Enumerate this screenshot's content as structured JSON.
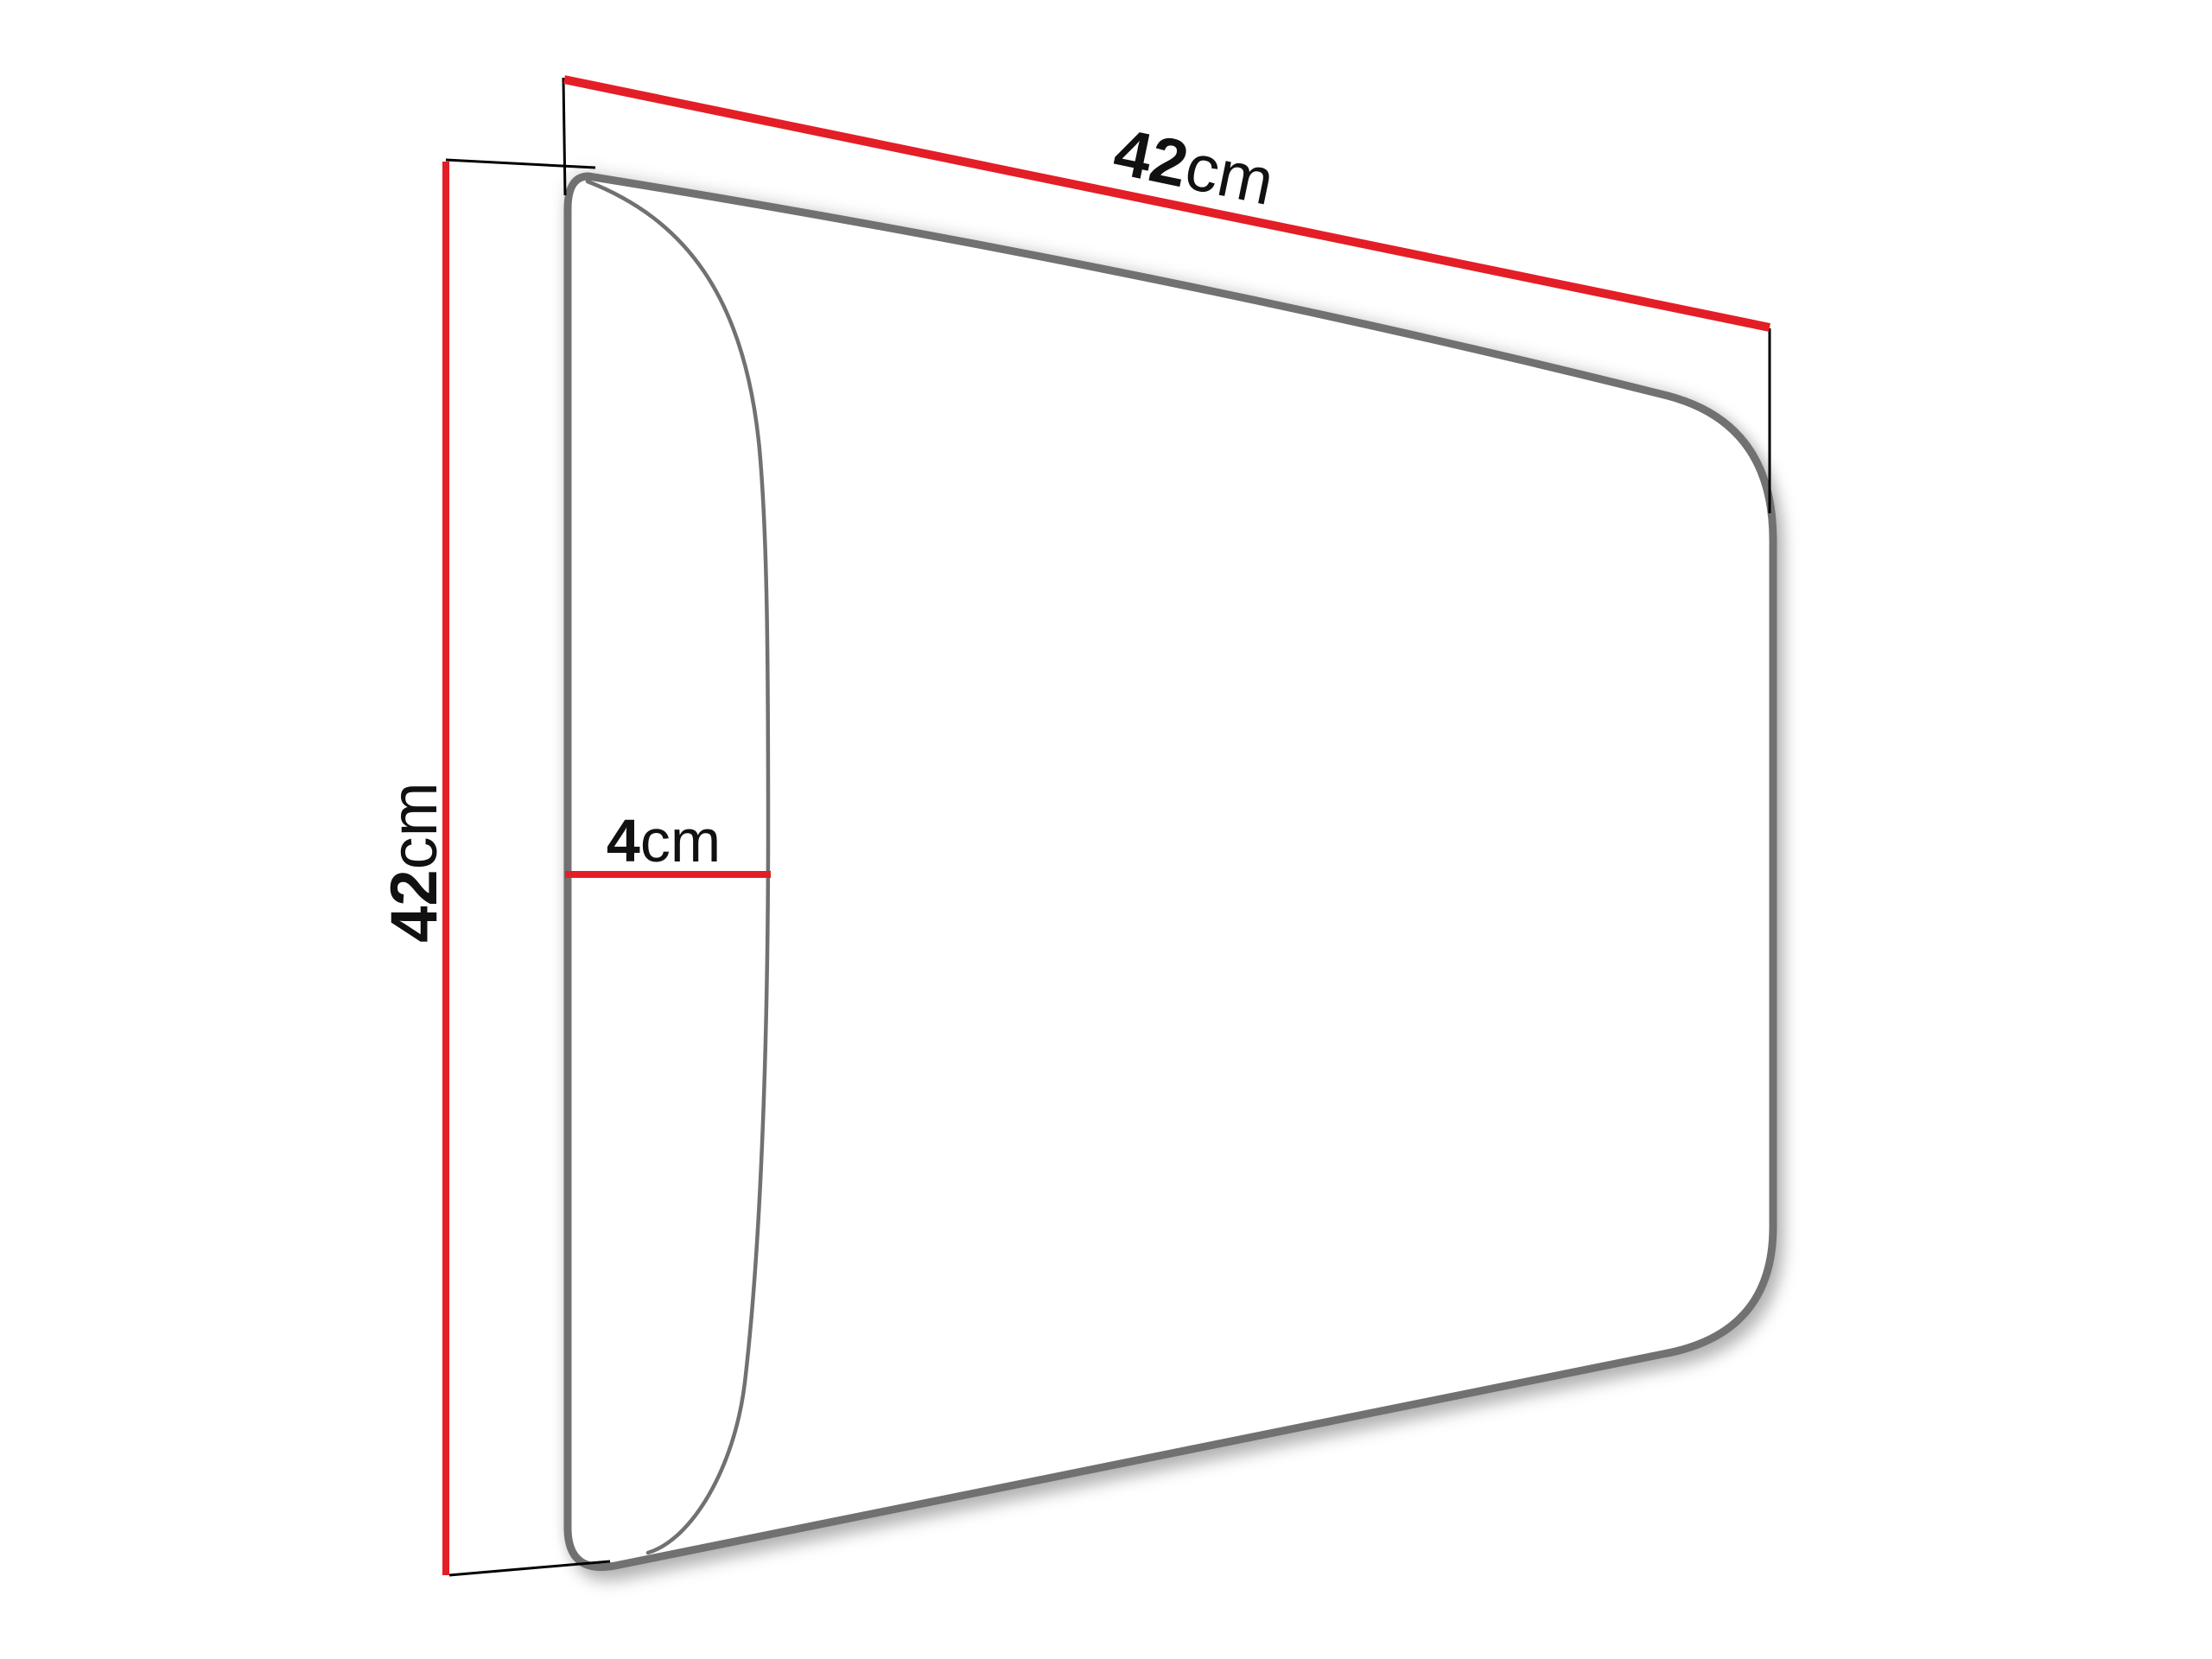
{
  "colors": {
    "dimension_red": "#e41e26",
    "outline_gray": "#717171",
    "extension_black": "#000000",
    "label_black": "#111111",
    "panel_fill": "#ffffff",
    "shadow": "#000000"
  },
  "labels": {
    "width": {
      "value": "42",
      "unit": "cm"
    },
    "height": {
      "value": "42",
      "unit": "cm"
    },
    "depth": {
      "value": "4",
      "unit": "cm"
    }
  }
}
